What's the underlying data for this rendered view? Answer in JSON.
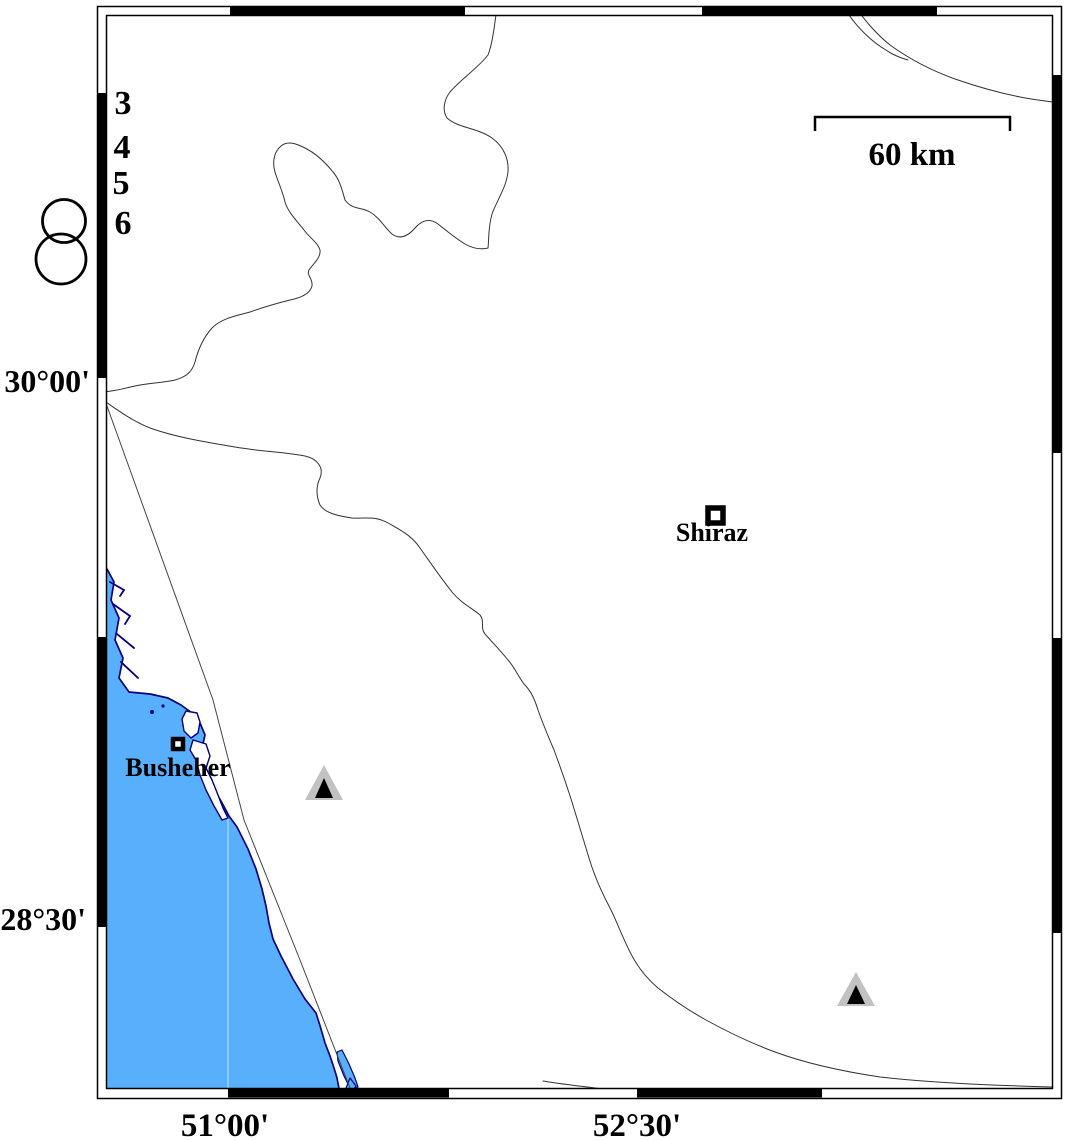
{
  "figure": {
    "kind": "seismicity-map",
    "region": "Busheher / Shiraz area, southern Iran"
  },
  "colors": {
    "sea": "#58affc",
    "coast_outline": "#000080",
    "frame_black": "#000000",
    "station_gray": "#c2c2c2"
  },
  "scale_bar": {
    "label": "60 km"
  },
  "legend": {
    "values": [
      "3",
      "4",
      "5",
      "6"
    ]
  },
  "cities": {
    "shiraz": "Shiraz",
    "busheher": "Busheher"
  },
  "axis_labels": {
    "lat_top": "30°00'",
    "lat_bottom": "28°30'",
    "lon_left": "51°00'",
    "lon_right": "52°30'"
  }
}
